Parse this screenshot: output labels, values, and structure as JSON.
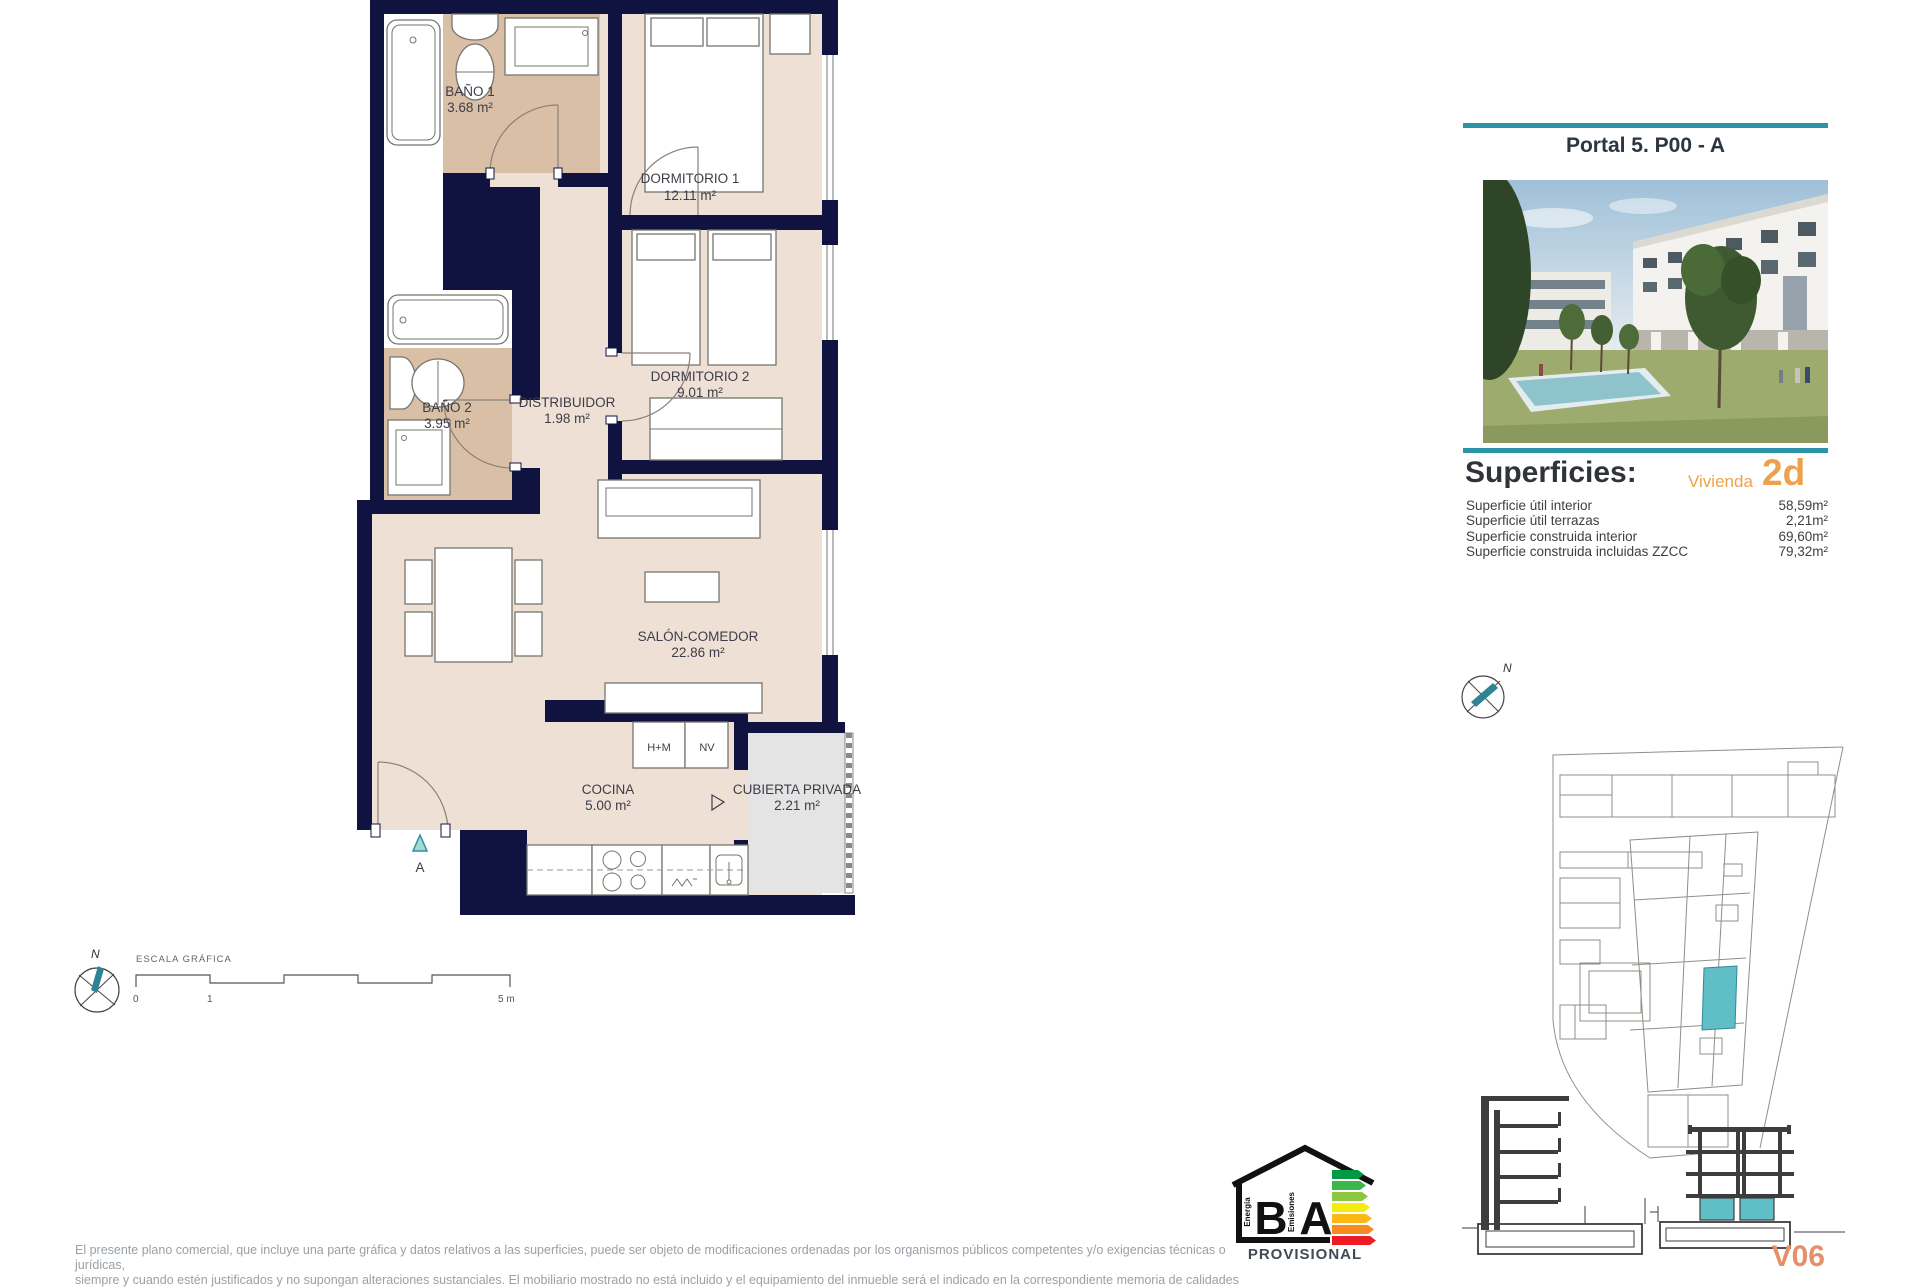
{
  "plan": {
    "rooms": [
      {
        "name": "BAÑO 1",
        "area": "3.68 m²"
      },
      {
        "name": "DORMITORIO 1",
        "area": "12.11 m²"
      },
      {
        "name": "BAÑO 2",
        "area": "3.95 m²"
      },
      {
        "name": "DISTRIBUIDOR",
        "area": "1.98 m²"
      },
      {
        "name": "DORMITORIO 2",
        "area": "9.01 m²"
      },
      {
        "name": "SALÓN-COMEDOR",
        "area": "22.86 m²"
      },
      {
        "name": "COCINA",
        "area": "5.00 m²"
      },
      {
        "name": "CUBIERTA PRIVADA",
        "area": "2.21 m²"
      }
    ],
    "kitchen_units": {
      "hm": "H+M",
      "nv": "NV"
    },
    "entrance_label": "A"
  },
  "scale_bar": {
    "title": "ESCALA GRÁFICA",
    "tick0": "0",
    "tick1": "1",
    "tick5": "5 m"
  },
  "compass": {
    "north": "N"
  },
  "sidebar": {
    "portal_title": "Portal 5. P00 - A",
    "superficies": {
      "title": "Superficies:",
      "vivienda_label": "Vivienda",
      "vivienda_code": "2d",
      "rows": [
        {
          "label": "Superficie útil interior",
          "value": "58,59m²"
        },
        {
          "label": "Superficie útil terrazas",
          "value": "2,21m²"
        },
        {
          "label": "Superficie construida interior",
          "value": "69,60m²"
        },
        {
          "label": "Superficie construida incluidas ZZCC",
          "value": "79,32m²"
        }
      ]
    },
    "site_compass_north": "N",
    "version": "V06"
  },
  "energy_badge": {
    "left_letter": "B",
    "right_letter": "A",
    "left_caption": "Energía",
    "right_caption": "Emisiones",
    "status": "PROVISIONAL"
  },
  "disclaimer": {
    "line1": "El presente plano comercial, que incluye una parte gráfica y datos relativos a las superficies, puede ser objeto de modificaciones ordenadas por los organismos públicos competentes y/o exigencias técnicas o jurídicas,",
    "line2": "siempre y cuando estén justificados y no supongan alteraciones sustanciales. El mobiliario mostrado no está incluido y el equipamiento del inmueble será el indicado en la correspondiente memoria de calidades"
  },
  "colors": {
    "accent_teal": "#2a93a5",
    "wall_navy": "#101340",
    "floor_beige": "#eee0d5",
    "bath_tan": "#d9bfa5",
    "highlight_teal": "#5fbec6",
    "orange": "#eca24c",
    "version_orange": "#e6906a"
  }
}
